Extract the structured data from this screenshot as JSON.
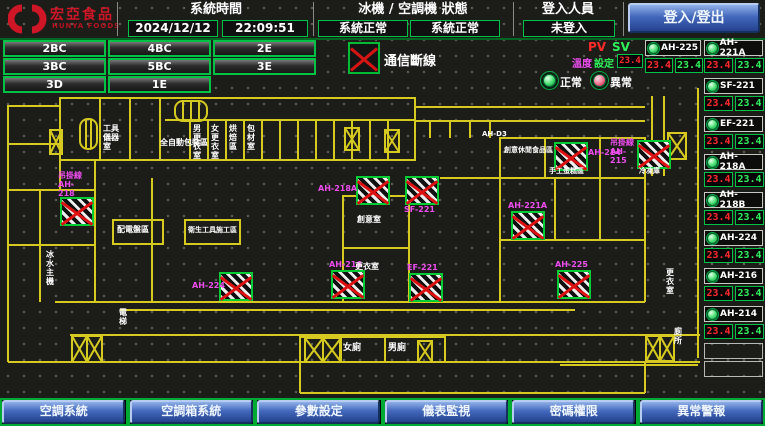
{
  "header": {
    "logo_title": "宏亞食品",
    "logo_subtitle": "HUNYA FOODS",
    "system_time_label": "系統時間",
    "date": "2024/12/12",
    "time": "22:09:51",
    "machine_status_label": "冰機 / 空調機 狀態",
    "chiller_status": "系統正常",
    "ahu_status": "系統正常",
    "login_label": "登入人員",
    "login_state": "未登入",
    "login_button_label": "登入/登出"
  },
  "floor_buttons": [
    "2BC",
    "4BC",
    "2E",
    "3BC",
    "5BC",
    "3E",
    "3D",
    "1E"
  ],
  "legend": {
    "comm_fail": "通信斷線",
    "pv": "PV",
    "sv": "SV",
    "setting_label_1": "溫度",
    "setting_label_2": "設定",
    "setting_value": "23.4",
    "normal": "正常",
    "abnormal": "異常"
  },
  "units": [
    {
      "name": "AH-225",
      "pv": "23.4",
      "sv": "23.4"
    },
    {
      "name": "AH-221A",
      "pv": "23.4",
      "sv": "23.4"
    },
    {
      "name": "SF-221",
      "pv": "23.4",
      "sv": "23.4"
    },
    {
      "name": "EF-221",
      "pv": "23.4",
      "sv": "23.4"
    },
    {
      "name": "AH-218A",
      "pv": "23.4",
      "sv": "23.4"
    },
    {
      "name": "AH-218B",
      "pv": "23.4",
      "sv": "23.4"
    },
    {
      "name": "AH-224",
      "pv": "23.4",
      "sv": "23.4"
    },
    {
      "name": "AH-216",
      "pv": "23.4",
      "sv": "23.4"
    },
    {
      "name": "AH-214",
      "pv": "23.4",
      "sv": "23.4"
    }
  ],
  "plan": {
    "rooms": [
      "工具儀器室",
      "全自動包裝區",
      "男更衣室",
      "女更衣室",
      "烘焙區",
      "包材室",
      "AH-D3",
      "創意休閒食品區",
      "手工蛋糕區",
      "冷凍庫",
      "配電盤區",
      "衛生工具施工區",
      "冰水主機",
      "創意室",
      "更衣室",
      "女廁",
      "男廁",
      "更衣室",
      "廁所",
      "電梯"
    ],
    "markers": [
      "吊掛線 AH-218",
      "AH-218A",
      "SF-221",
      "AH-221A",
      "AH-214",
      "吊掛線 AH-215",
      "AH-224",
      "AH-216",
      "EF-221",
      "AH-225"
    ]
  },
  "footer_buttons": [
    "空調系統",
    "空調箱系統",
    "參數設定",
    "儀表監視",
    "密碼權限",
    "異常警報"
  ]
}
